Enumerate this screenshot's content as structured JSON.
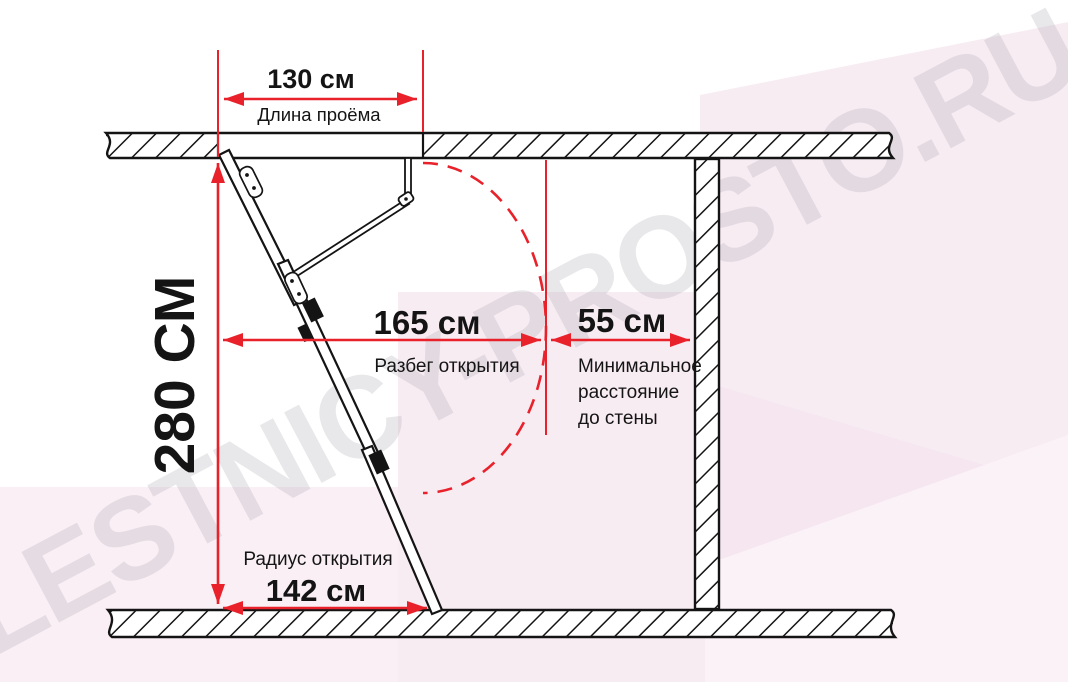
{
  "watermark": {
    "text": "LESTNICY-PROSTO.RU"
  },
  "colors": {
    "dimension_red": "#e8212b",
    "line_black": "#141414",
    "bg_pink": "#f8ecf3",
    "bg_pink_light": "#fbf3f8",
    "bg_pink_dark": "#f2e2ec",
    "watermark_gray": "#b9b6bd"
  },
  "dimensions": {
    "opening_length": {
      "value": "130 см",
      "label": "Длина проёма"
    },
    "ceiling_height": {
      "value": "280 СМ"
    },
    "opening_run": {
      "value": "165 см",
      "label": "Разбег открытия"
    },
    "wall_clearance": {
      "value": "55 см",
      "label_line_1": "Минимальное",
      "label_line_2": "расстояние",
      "label_line_3": "до стены"
    },
    "opening_radius": {
      "value": "142 см",
      "label": "Радиус открытия"
    }
  }
}
